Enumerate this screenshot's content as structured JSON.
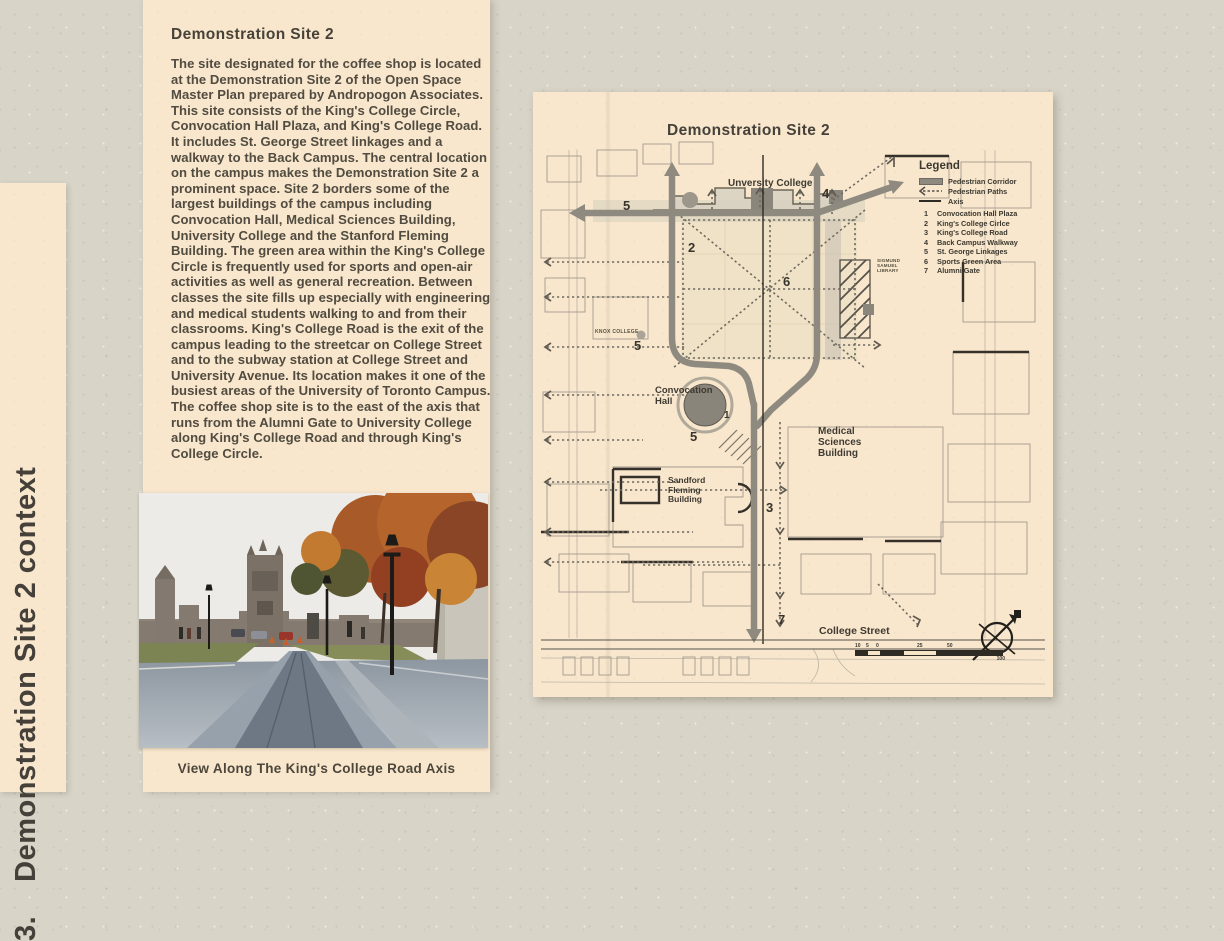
{
  "sidebar": {
    "section_number": "3.",
    "section_title": "Demonstration Site 2 context"
  },
  "article": {
    "heading": "Demonstration Site 2",
    "body": "The site designated for the coffee shop is located at the Demonstration Site 2 of the Open Space Master Plan prepared by Andropogon Associates. This site consists of the King's College Circle, Convocation Hall Plaza, and King's College Road. It includes St. George Street linkages and a walkway to the Back Campus. The central location on the campus makes the Demonstration Site 2 a prominent space. Site 2 borders some of the largest buildings of the campus including Convocation Hall, Medical Sciences Building, University College and the Stanford Fleming Building. The green area within the King's College Circle is frequently used for sports and open-air activities as well as general recreation. Between classes the site fills up especially with engineering and medical students walking to and from their classrooms. King's College Road is the exit of the campus leading to the streetcar on College Street and to the subway station at College Street and University Avenue. Its location makes it one of the busiest areas of the University of Toronto Campus. The coffee shop site is to the east of the axis that runs from the Alumni Gate to University College along King's College Road and through King's College Circle.",
    "photo_caption": "View Along The King's College Road Axis"
  },
  "map": {
    "title": "Demonstration Site 2",
    "labels": {
      "university_college": "Unversity College",
      "knox_college": "KNOX COLLEGE",
      "library": [
        "SIGMUND",
        "SAMUEL",
        "LIBRARY"
      ],
      "convocation": [
        "Convocation",
        "Hall"
      ],
      "medical": [
        "Medical",
        "Sciences",
        "Building"
      ],
      "sandford": [
        "Sandford",
        "Fleming",
        "Building"
      ],
      "college_street": "College Street"
    },
    "markers": {
      "m1": "1",
      "m2": "2",
      "m3": "3",
      "m4": "4",
      "m5a": "5",
      "m5b": "5",
      "m5c": "5",
      "m6": "6",
      "m7": "7"
    },
    "legend": {
      "title": "Legend",
      "symbol_items": [
        {
          "icon": "corridor-bar",
          "label": "Pedestrian Corridor"
        },
        {
          "icon": "dashed-arrow",
          "label": "Pedestrian Paths"
        },
        {
          "icon": "axis-line",
          "label": "Axis"
        }
      ],
      "numbered_items": [
        {
          "num": "1",
          "label": "Convocation Hall Plaza"
        },
        {
          "num": "2",
          "label": "King's College Cirlce"
        },
        {
          "num": "3",
          "label": "King's College Road"
        },
        {
          "num": "4",
          "label": "Back Campus Walkway"
        },
        {
          "num": "5",
          "label": "St. George Linkages"
        },
        {
          "num": "6",
          "label": "Sports Green Area"
        },
        {
          "num": "7",
          "label": "Alumni Gate"
        }
      ]
    },
    "scale": {
      "labels_top": [
        "10",
        "5",
        "0",
        "25",
        "50"
      ],
      "label_bottom": "100"
    }
  },
  "colors": {
    "cardboard": "#d8d4c8",
    "panel_cream": "#f8e7cd",
    "ink": "#4b463c",
    "corridor_gray": "#8f8a80",
    "autumn_orange": "#b5652c"
  }
}
